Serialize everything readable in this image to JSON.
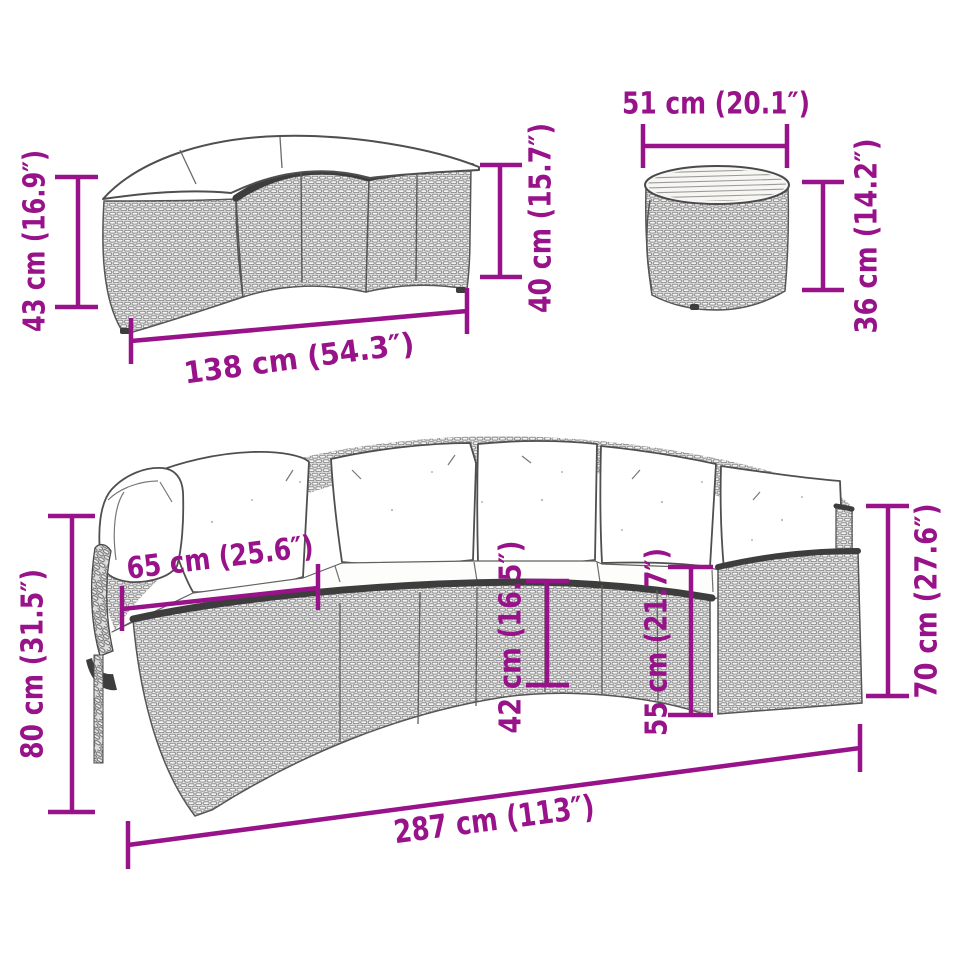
{
  "colors": {
    "background": "#ffffff",
    "dimension": "#98128A",
    "furniture_outline": "#4f4f4f",
    "weave_light": "#e9e9e9",
    "weave_dark": "#8d8d8d",
    "edge_dark": "#3d3d3d",
    "cushion_white": "#ffffff"
  },
  "bench": {
    "height_left_label": "43 cm (16.9″)",
    "height_right_label": "40 cm (15.7″)",
    "width_label": "138 cm (54.3″)"
  },
  "table": {
    "diameter_label": "51 cm (20.1″)",
    "height_label": "36 cm (14.2″)"
  },
  "sofa": {
    "back_height_label": "80 cm (31.5″)",
    "inner_width_label": "65 cm (25.6″)",
    "seat_front_height_label": "42 cm (16.5″)",
    "seat_back_height_label": "55 cm (21.7″)",
    "arm_height_label": "70 cm (27.6″)",
    "total_width_label": "287 cm (113″)"
  }
}
